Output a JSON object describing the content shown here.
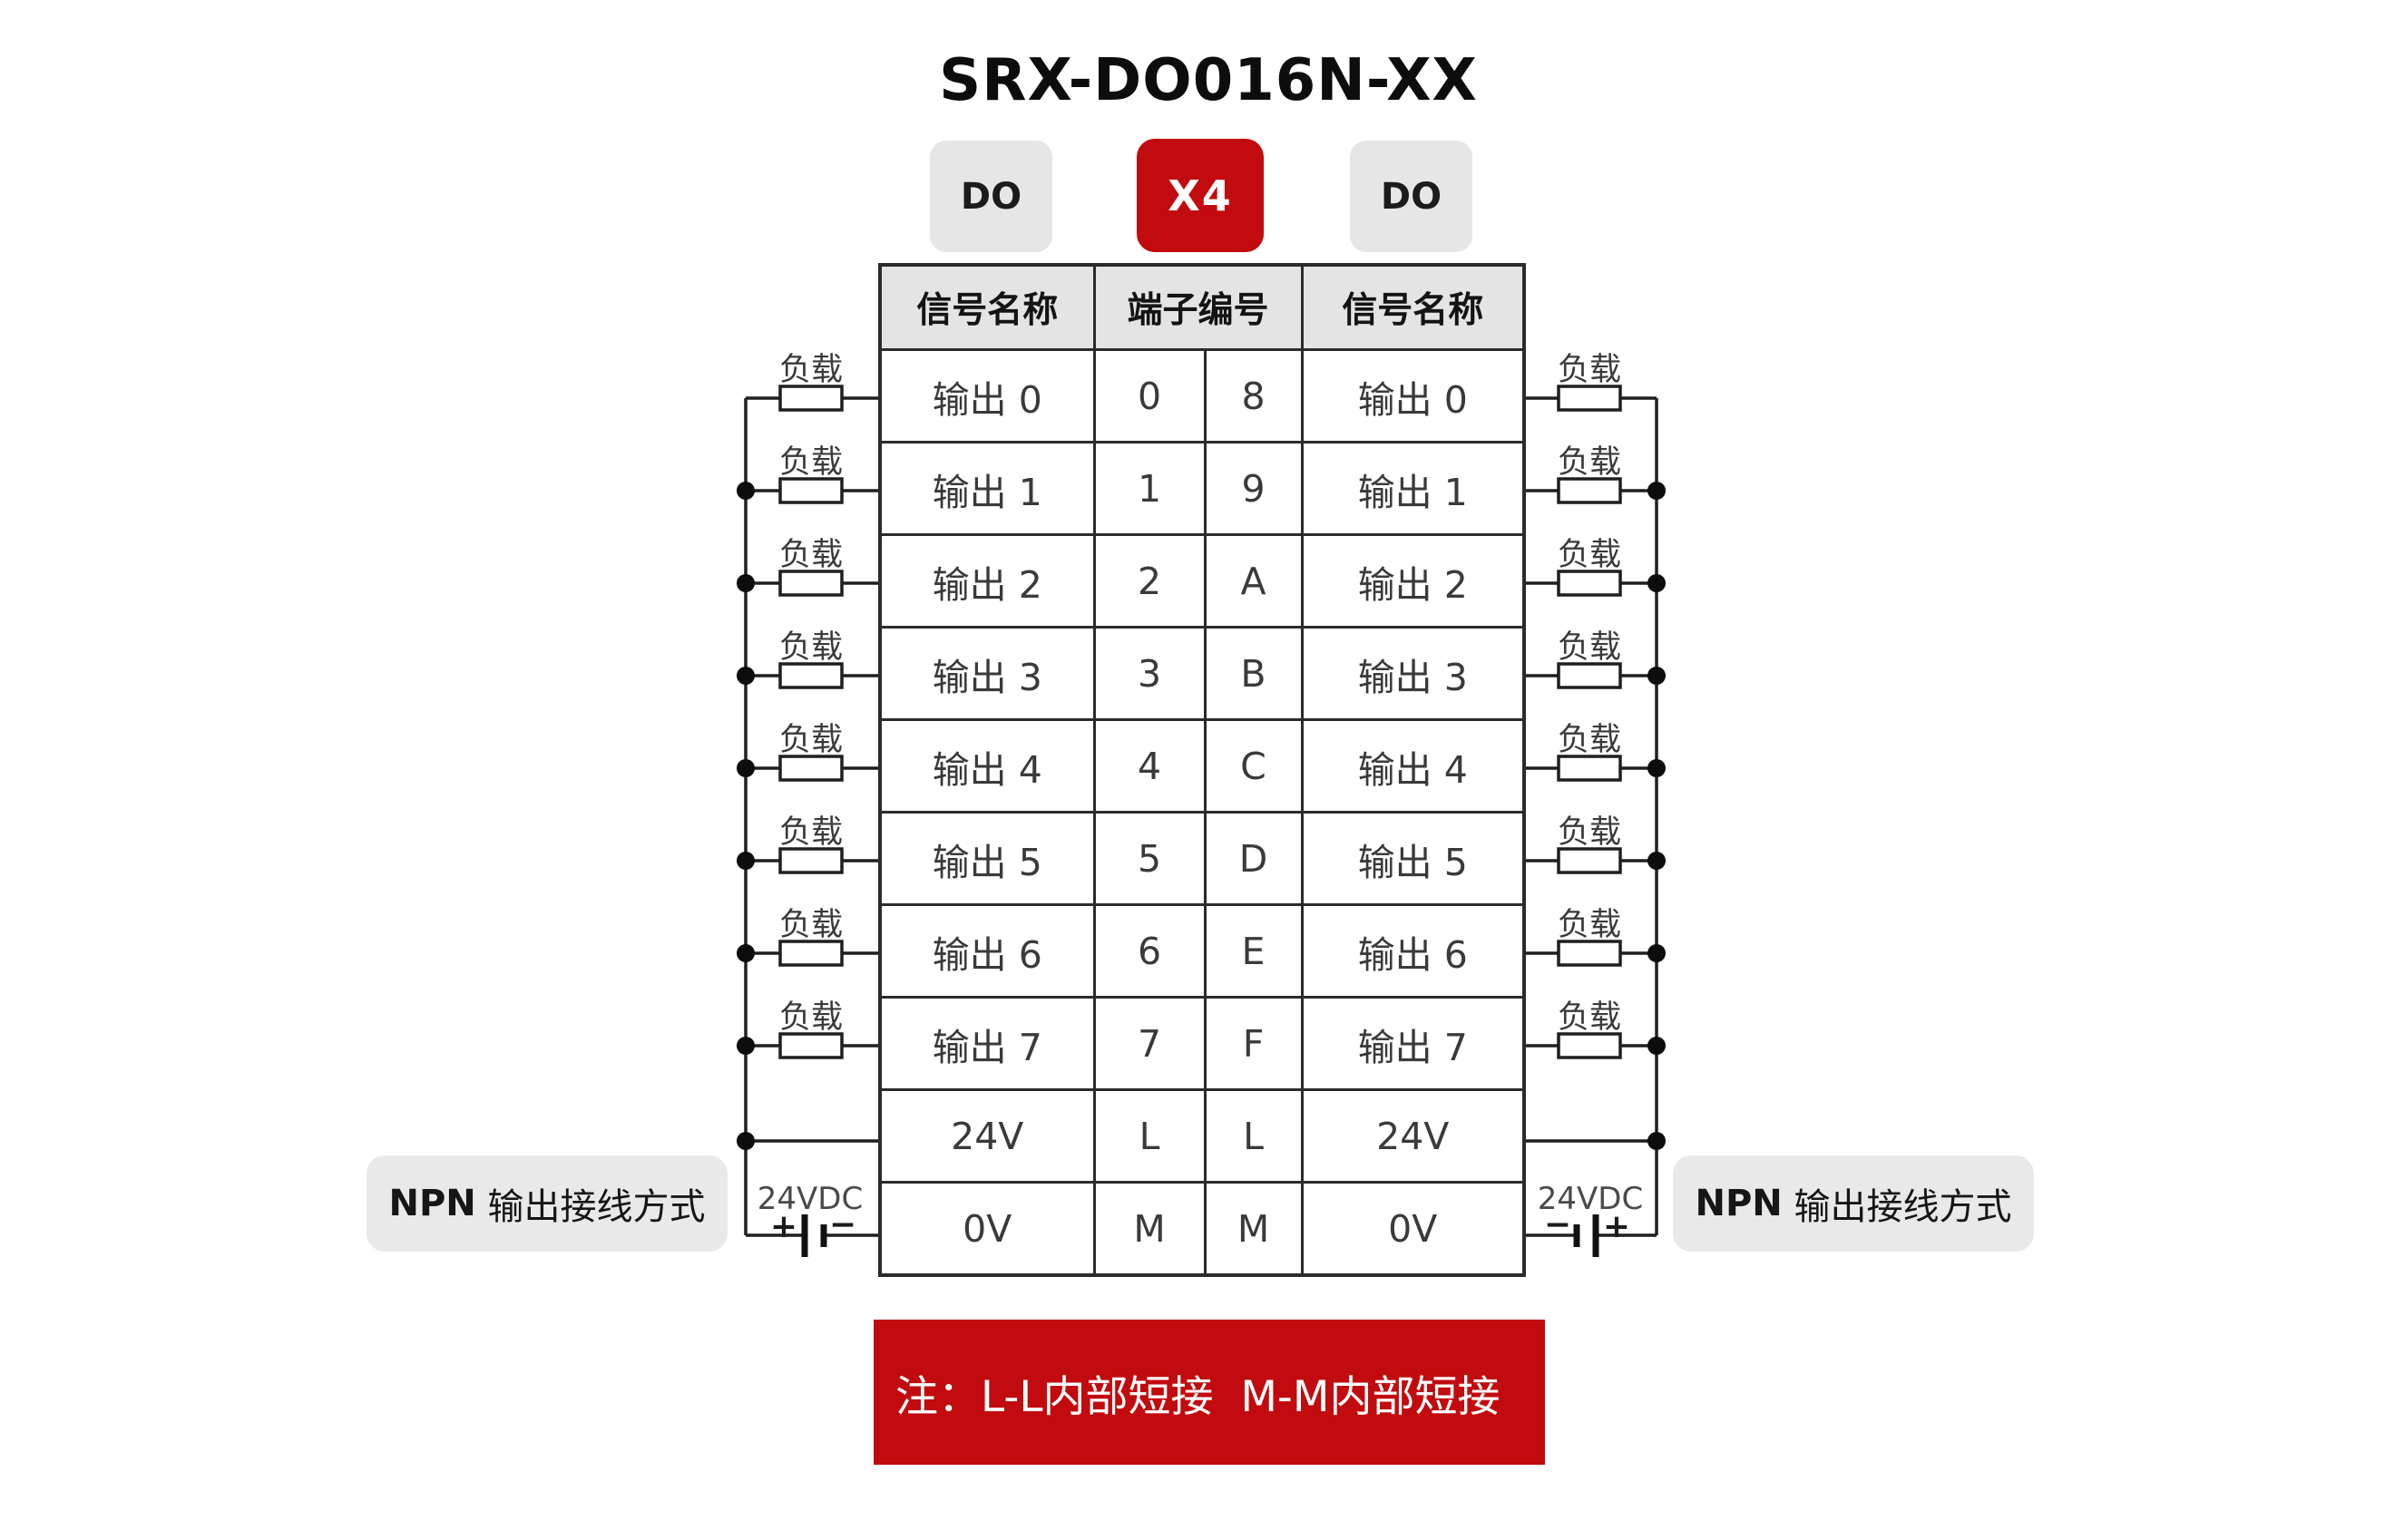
{
  "page_title": "SRX-DO016N-XX",
  "badges": {
    "left": "DO",
    "center": "X4",
    "right": "DO"
  },
  "table": {
    "headers": {
      "left": "信号名称",
      "middle": "端子编号",
      "right": "信号名称"
    },
    "rows": [
      {
        "left": "输出 0",
        "t1": "0",
        "t2": "8",
        "right": "输出 0"
      },
      {
        "left": "输出 1",
        "t1": "1",
        "t2": "9",
        "right": "输出 1"
      },
      {
        "left": "输出 2",
        "t1": "2",
        "t2": "A",
        "right": "输出 2"
      },
      {
        "left": "输出 3",
        "t1": "3",
        "t2": "B",
        "right": "输出 3"
      },
      {
        "left": "输出 4",
        "t1": "4",
        "t2": "C",
        "right": "输出 4"
      },
      {
        "left": "输出 5",
        "t1": "5",
        "t2": "D",
        "right": "输出 5"
      },
      {
        "left": "输出 6",
        "t1": "6",
        "t2": "E",
        "right": "输出 6"
      },
      {
        "left": "输出 7",
        "t1": "7",
        "t2": "F",
        "right": "输出 7"
      },
      {
        "left": "24V",
        "t1": "L",
        "t2": "L",
        "right": "24V"
      },
      {
        "left": "0V",
        "t1": "M",
        "t2": "M",
        "right": "0V"
      }
    ]
  },
  "wiring": {
    "load_label": "负载",
    "supply_label": "24VDC",
    "plus": "+",
    "minus": "−"
  },
  "npn": {
    "bold": "NPN",
    "rest": " 输出接线方式"
  },
  "note": "注：L-L内部短接  M-M内部短接",
  "colors": {
    "accent_red": "#c20b0e",
    "badge_gray": "#e6e6e6",
    "header_gray": "#e4e4e4",
    "line_black": "#1f1f1f"
  }
}
